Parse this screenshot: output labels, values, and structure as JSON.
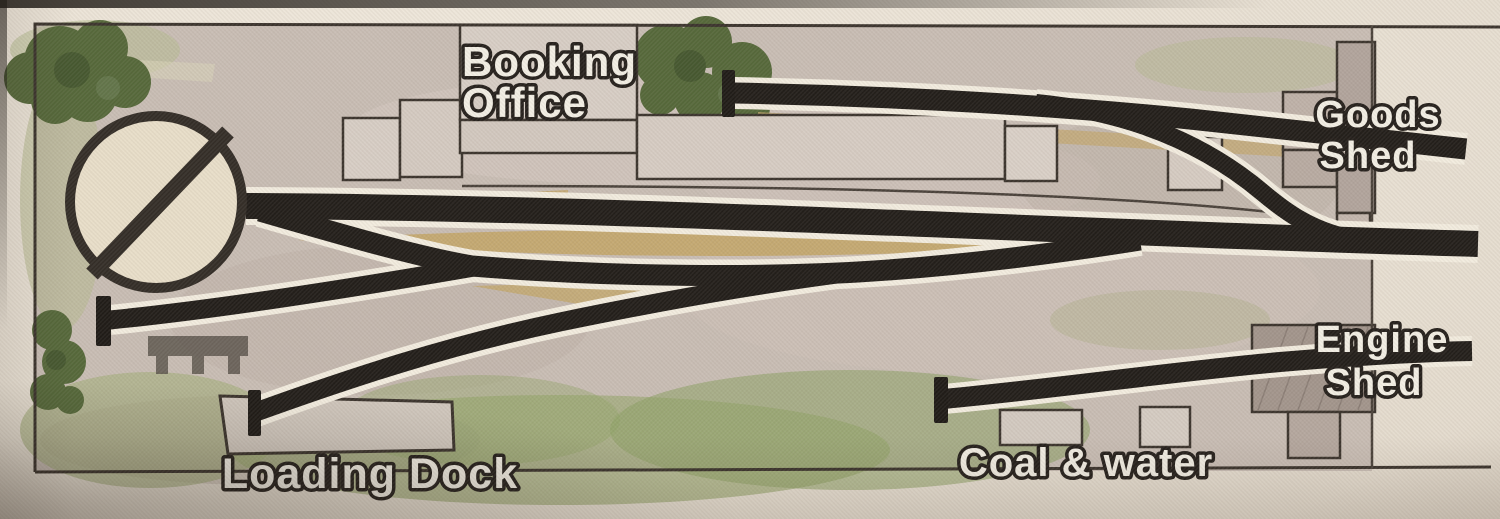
{
  "diagram": {
    "type": "model-railway-track-plan",
    "labels": {
      "booking_office_line1": "Booking",
      "booking_office_line2": "Office",
      "goods_shed_line1": "Goods",
      "goods_shed_line2": "Shed",
      "engine_shed_line1": "Engine",
      "engine_shed_line2": "Shed",
      "coal_water": "Coal & water",
      "loading_dock": "Loading Dock"
    },
    "features": [
      "turntable",
      "main-line-track",
      "run-round-loop-track",
      "goods-siding-track",
      "engine-shed-track",
      "loading-dock-track",
      "left-siding-track",
      "connecting-curve-track",
      "buffer-stops",
      "station-buildings",
      "platform",
      "trees",
      "grass",
      "scenic-break-line"
    ],
    "colors": {
      "paper": "#e9e1d5",
      "ground": "#c8bdb4",
      "track_black": "#221e1a",
      "track_casing": "#f2ecdf",
      "platform_khaki": "#c3a76d",
      "building_fill": "#d6ccc3",
      "shed_fill": "#a89b92",
      "tree_green": "#55683a",
      "grass_green": "#99a871",
      "label_fill": "#f2eee4",
      "label_outline": "#25201c",
      "border_line": "#3b342d"
    }
  }
}
